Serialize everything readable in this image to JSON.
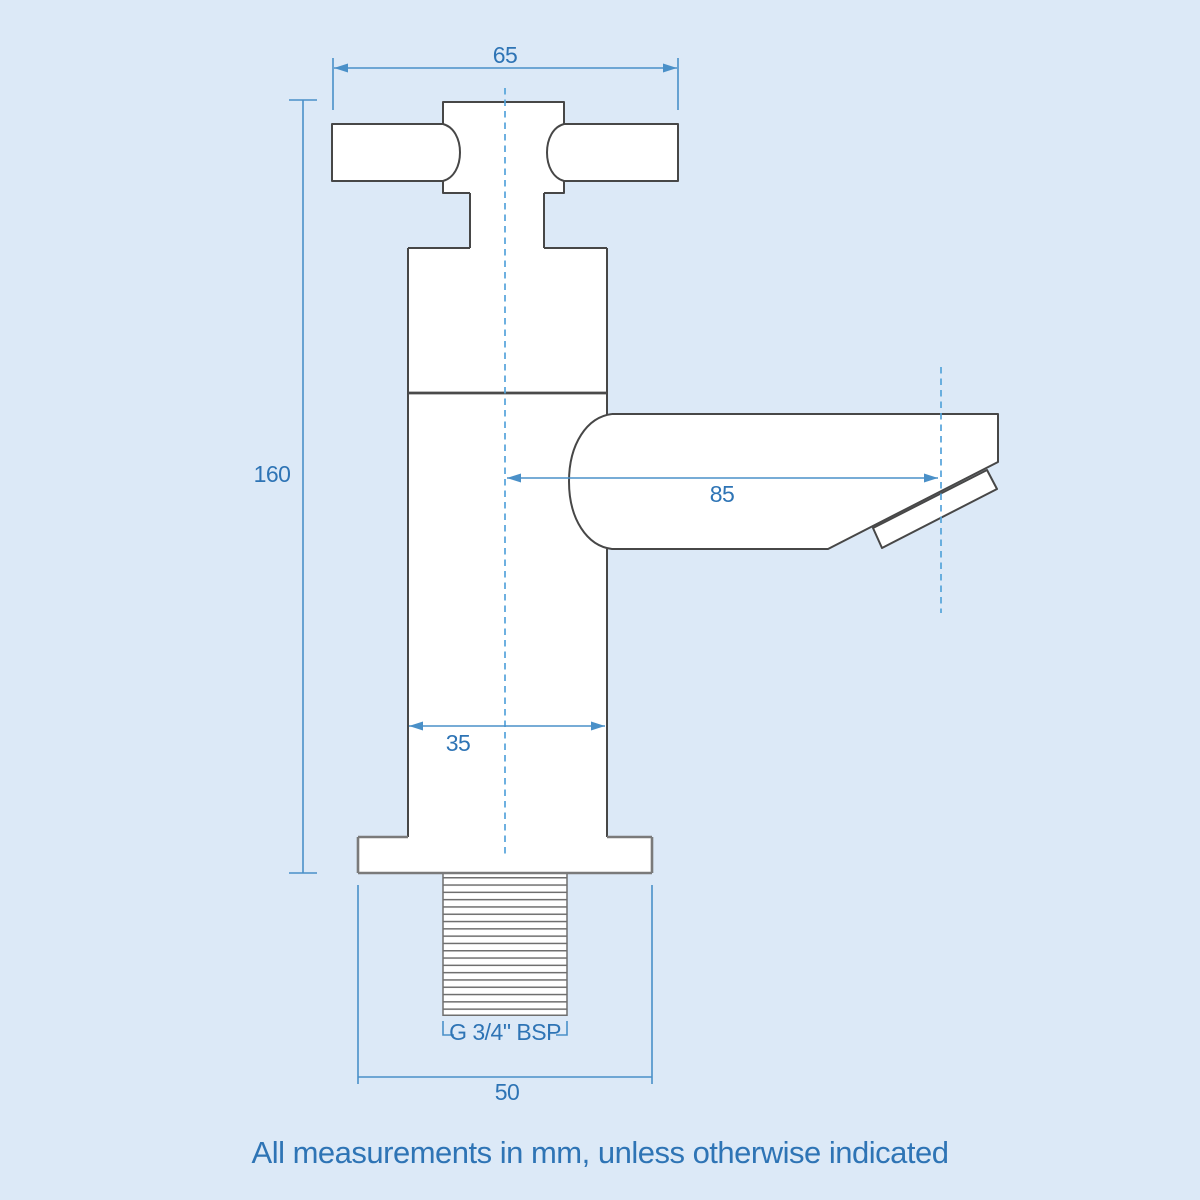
{
  "diagram": {
    "subject": "pillar tap with cross handle - technical line drawing",
    "units": "mm",
    "note": "All measurements in mm, unless otherwise indicated",
    "colors": {
      "background": "#dce9f7",
      "outline_dark": "#474747",
      "outline_gray": "#7a7a7a",
      "thread_gray": "#6f6f6f",
      "dimension_line": "#4a90c8",
      "dimension_text": "#2e74b5",
      "centerline": "#54a3da",
      "shape_fill": "#ffffff"
    },
    "dimensions": {
      "handle_width": "65",
      "overall_height": "160",
      "spout_reach": "85",
      "body_width": "35",
      "base_width": "50",
      "thread": "G 3/4\" BSP"
    }
  }
}
